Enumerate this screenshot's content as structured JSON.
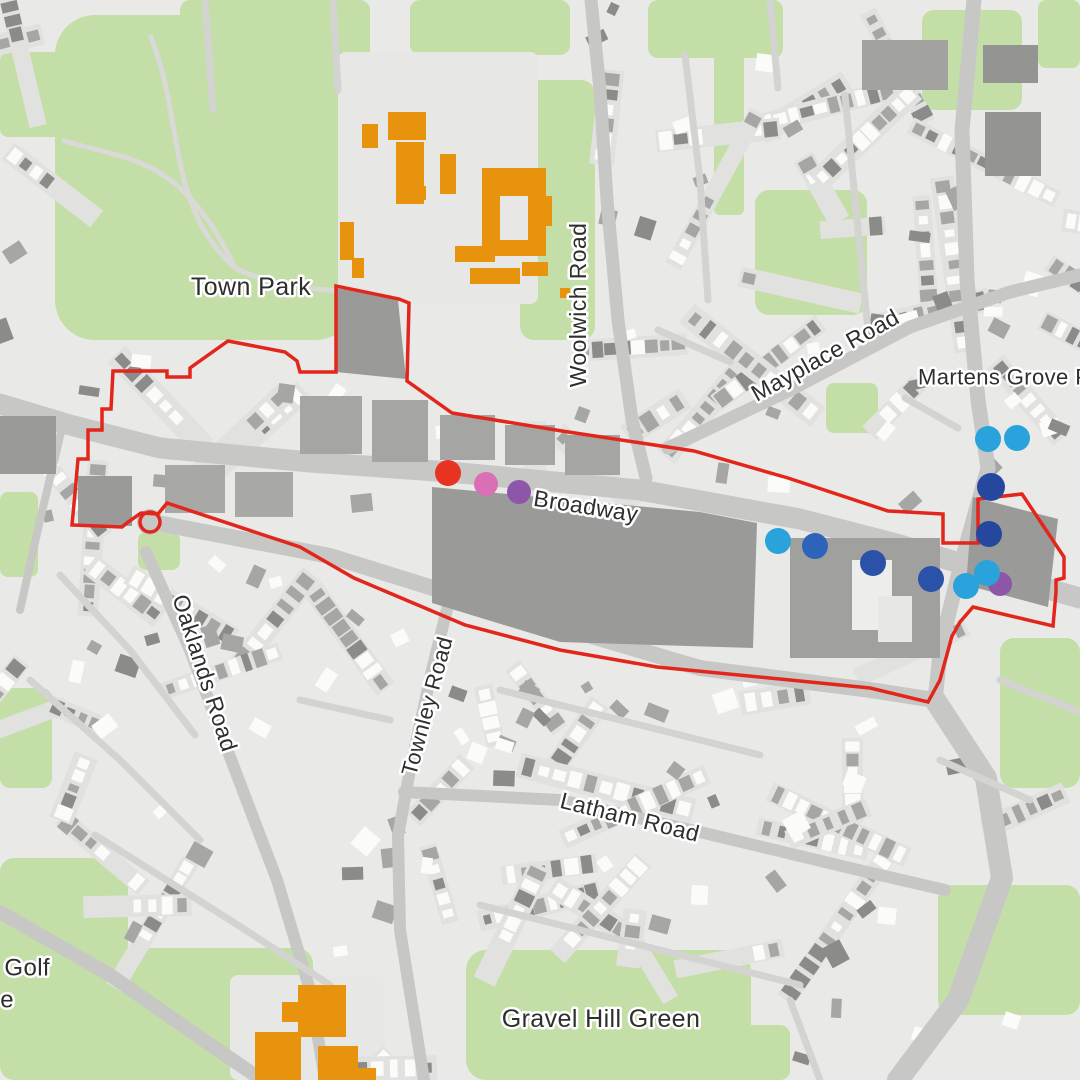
{
  "map": {
    "colors": {
      "background": "#E9E9E7",
      "park": "#C4DEA7",
      "road": "#C7C7C5",
      "minor_road": "#D3D3D1",
      "building_white": "#FBFBF9",
      "building_mid": "#A6A6A4",
      "building_dark": "#8B8B89",
      "block_dark": "#9A9A98",
      "school_building": "#E8930E",
      "boundary": "#E2261C",
      "label_text": "#2E2E2E"
    },
    "labels": [
      {
        "id": "town-park",
        "text": "Town Park",
        "x": 251,
        "y": 287,
        "rotate": 0,
        "size": 25,
        "anchor": "middle"
      },
      {
        "id": "woolwich-road",
        "text": "Woolwich Road",
        "x": 578,
        "y": 305,
        "rotate": -90,
        "size": 23,
        "anchor": "middle"
      },
      {
        "id": "mayplace-road",
        "text": "Mayplace Road",
        "x": 825,
        "y": 355,
        "rotate": -29,
        "size": 23,
        "anchor": "middle"
      },
      {
        "id": "martens-grove-park",
        "text": "Martens Grove Park",
        "x": 918,
        "y": 377,
        "rotate": 0,
        "size": 22,
        "anchor": "start"
      },
      {
        "id": "broadway",
        "text": "Broadway",
        "x": 586,
        "y": 506,
        "rotate": 9,
        "size": 23,
        "anchor": "middle"
      },
      {
        "id": "oaklands-road",
        "text": "Oaklands Road",
        "x": 205,
        "y": 673,
        "rotate": 72,
        "size": 23,
        "anchor": "middle"
      },
      {
        "id": "townley-road",
        "text": "Townley  Road",
        "x": 427,
        "y": 706,
        "rotate": -75,
        "size": 22,
        "anchor": "middle"
      },
      {
        "id": "latham-road",
        "text": "Latham Road",
        "x": 630,
        "y": 817,
        "rotate": 14,
        "size": 23,
        "anchor": "middle"
      },
      {
        "id": "gravel-hill-green",
        "text": "Gravel Hill Green",
        "x": 601,
        "y": 1019,
        "rotate": 0,
        "size": 25,
        "anchor": "middle"
      },
      {
        "id": "golf-fragment-line1",
        "text": "n Golf",
        "x": 50,
        "y": 968,
        "rotate": 0,
        "size": 24,
        "anchor": "end"
      },
      {
        "id": "golf-fragment-line2",
        "text": "e",
        "x": 14,
        "y": 1000,
        "rotate": 0,
        "size": 24,
        "anchor": "end"
      }
    ],
    "markers": [
      {
        "color": "#E63322",
        "x": 448,
        "y": 473,
        "r": 13
      },
      {
        "color": "#DB6FB5",
        "x": 486,
        "y": 484,
        "r": 12
      },
      {
        "color": "#8E56A8",
        "x": 519,
        "y": 492,
        "r": 12
      },
      {
        "color": "#2AA2DB",
        "x": 778,
        "y": 541,
        "r": 13
      },
      {
        "color": "#2D63B8",
        "x": 815,
        "y": 546,
        "r": 13
      },
      {
        "color": "#2A52A8",
        "x": 873,
        "y": 563,
        "r": 13
      },
      {
        "color": "#2A52A8",
        "x": 931,
        "y": 579,
        "r": 13
      },
      {
        "color": "#8E56A8",
        "x": 1000,
        "y": 584,
        "r": 12
      },
      {
        "color": "#2AA2DB",
        "x": 966,
        "y": 586,
        "r": 13
      },
      {
        "color": "#2AA2DB",
        "x": 987,
        "y": 573,
        "r": 13
      },
      {
        "color": "#26479E",
        "x": 989,
        "y": 534,
        "r": 13
      },
      {
        "color": "#26479E",
        "x": 991,
        "y": 487,
        "r": 14
      },
      {
        "color": "#2AA2DB",
        "x": 988,
        "y": 439,
        "r": 13
      },
      {
        "color": "#2AA2DB",
        "x": 1017,
        "y": 438,
        "r": 13
      }
    ],
    "boundary": {
      "stroke_width": 3.5,
      "roundabout": {
        "cx": 150,
        "cy": 522,
        "r": 10
      },
      "points": [
        [
          113,
          371
        ],
        [
          167,
          371
        ],
        [
          167,
          377
        ],
        [
          190,
          377
        ],
        [
          190,
          368
        ],
        [
          228,
          341
        ],
        [
          285,
          352
        ],
        [
          297,
          361
        ],
        [
          300,
          372
        ],
        [
          336,
          372
        ],
        [
          336,
          286
        ],
        [
          399,
          299
        ],
        [
          409,
          303
        ],
        [
          407,
          381
        ],
        [
          452,
          413
        ],
        [
          562,
          431
        ],
        [
          694,
          451
        ],
        [
          788,
          478
        ],
        [
          888,
          511
        ],
        [
          943,
          514
        ],
        [
          943,
          543
        ],
        [
          978,
          543
        ],
        [
          978,
          499
        ],
        [
          1022,
          494
        ],
        [
          1064,
          557
        ],
        [
          1064,
          578
        ],
        [
          1056,
          580
        ],
        [
          1056,
          592
        ],
        [
          1053,
          626
        ],
        [
          973,
          607
        ],
        [
          960,
          622
        ],
        [
          952,
          636
        ],
        [
          940,
          680
        ],
        [
          928,
          702
        ],
        [
          870,
          688
        ],
        [
          790,
          680
        ],
        [
          657,
          667
        ],
        [
          560,
          650
        ],
        [
          465,
          625
        ],
        [
          354,
          578
        ],
        [
          300,
          547
        ],
        [
          167,
          503
        ],
        [
          158,
          514
        ],
        [
          141,
          513
        ],
        [
          128,
          522
        ],
        [
          122,
          527
        ],
        [
          72,
          525
        ],
        [
          75,
          493
        ],
        [
          78,
          459
        ],
        [
          88,
          459
        ],
        [
          88,
          430
        ],
        [
          102,
          430
        ],
        [
          102,
          409
        ],
        [
          111,
          409
        ]
      ]
    }
  }
}
